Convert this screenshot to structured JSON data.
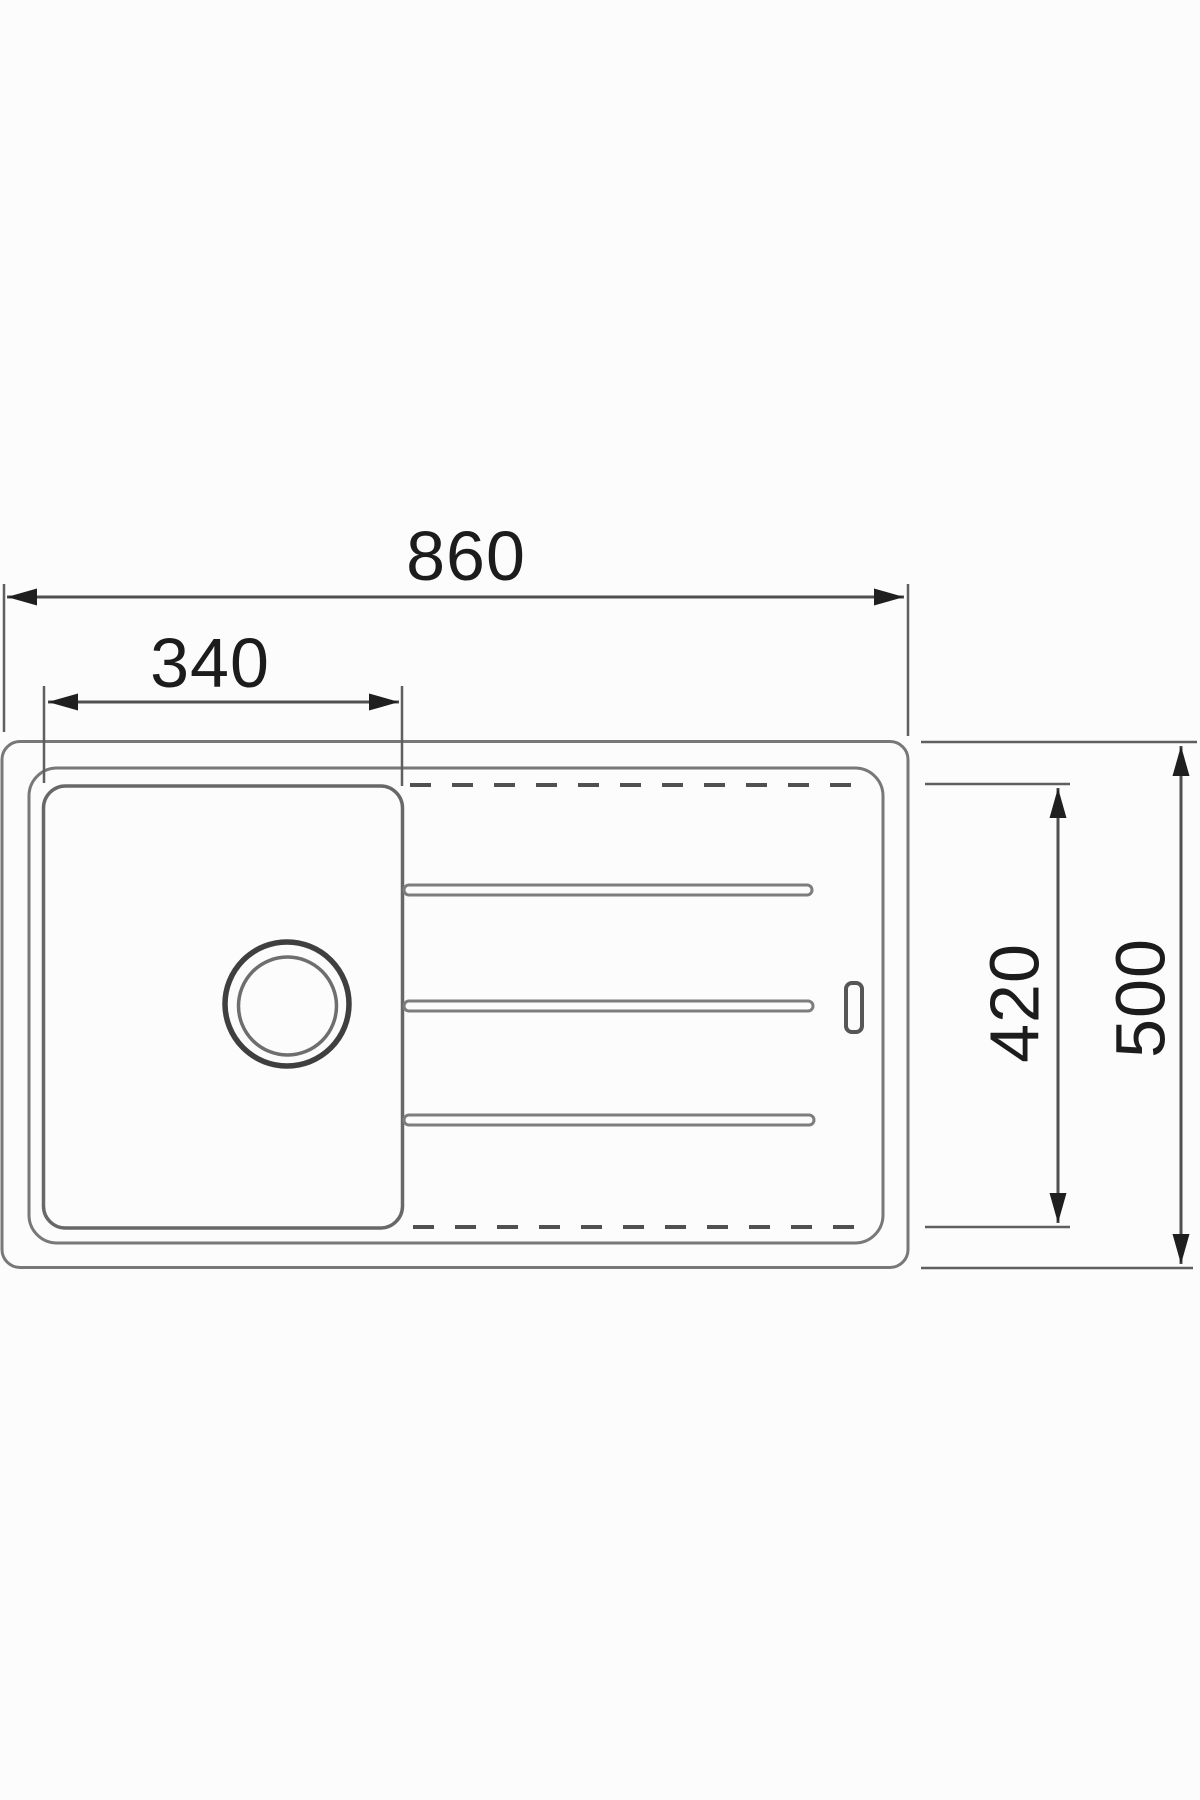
{
  "drawing": {
    "type": "technical-dimension-drawing",
    "subject": "kitchen sink with single bowl and drainer, top view",
    "unit": "mm",
    "labels": {
      "overall_width": "860",
      "bowl_width": "340",
      "inner_depth": "420",
      "overall_depth": "500"
    },
    "colors": {
      "background": "#fcfcfc",
      "outline": "#787878",
      "bowl_outline": "#686868",
      "groove": "#7d7d7d",
      "dashed": "#505050",
      "dimension": "#4f4f4f",
      "extension": "#5f5f5f",
      "arrow": "#1f1f1f",
      "text": "#1c1c1c",
      "drain_outer": "#3f3f3f",
      "drain_inner": "#6e6e6e",
      "overflow": "#565656"
    }
  }
}
